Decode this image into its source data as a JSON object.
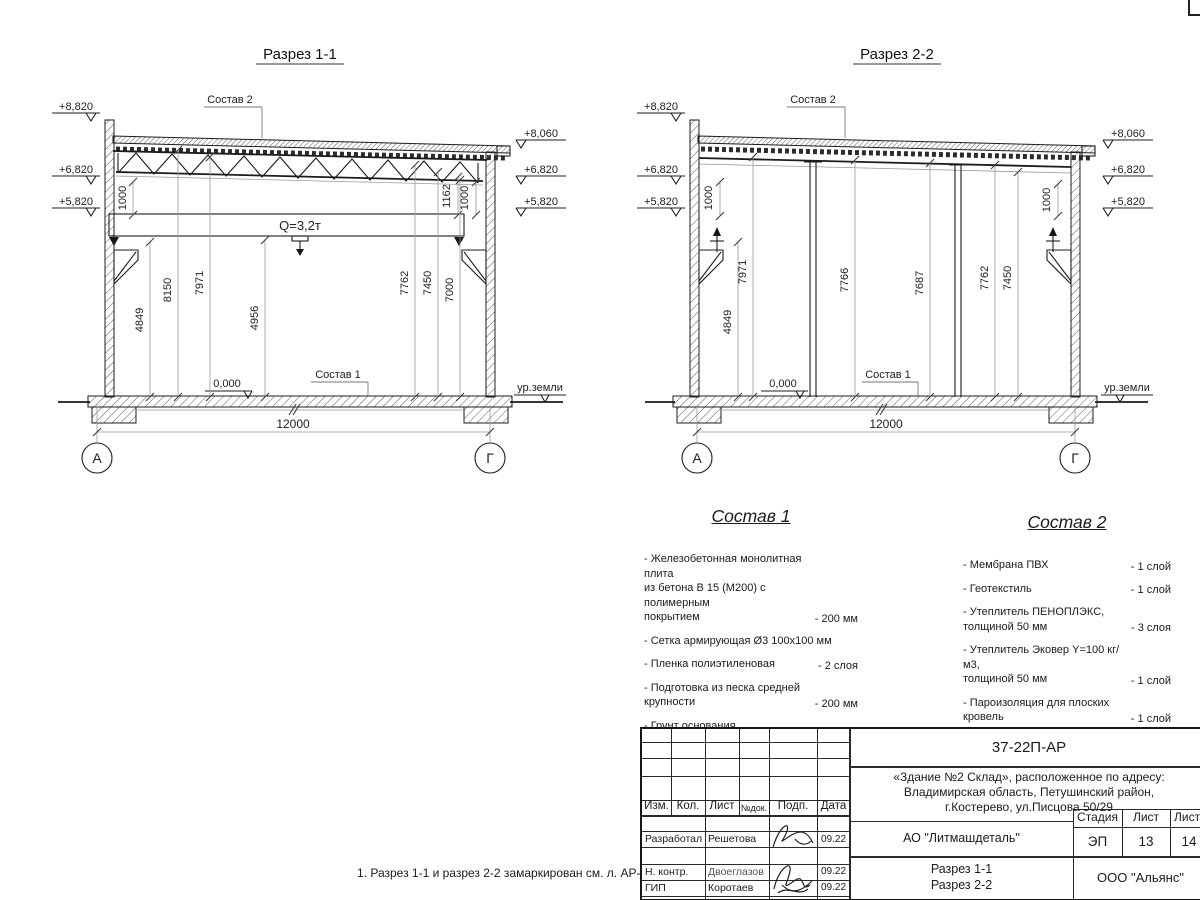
{
  "s1": {
    "title": "Разрез 1-1",
    "elev_left": [
      "+8,820",
      "+6,820",
      "+5,820"
    ],
    "elev_right": [
      "+8,060",
      "+6,820",
      "+5,820"
    ],
    "sostav2_label": "Состав 2",
    "sostav1_label": "Состав 1",
    "crane_label": "Q=3,2т",
    "dim_1000_left": "1000",
    "dim_1162": "1162",
    "dim_1000_right": "1000",
    "vdims": [
      "4849",
      "8150",
      "7971",
      "4956",
      "7762",
      "7450",
      "7000"
    ],
    "zero_level": "0,000",
    "ground_label": "ур.земли",
    "span_dim": "12000",
    "axis_left": "А",
    "axis_right": "Г"
  },
  "s2": {
    "title": "Разрез 2-2",
    "elev_left": [
      "+8,820",
      "+6,820",
      "+5,820"
    ],
    "elev_right": [
      "+8,060",
      "+6,820",
      "+5,820"
    ],
    "sostav2_label": "Состав 2",
    "sostav1_label": "Состав 1",
    "dim_1000_left": "1000",
    "dim_1000_right": "1000",
    "vdims": [
      "4849",
      "7971",
      "7766",
      "7687",
      "7762",
      "7450"
    ],
    "zero_level": "0,000",
    "ground_label": "ур.земли",
    "span_dim": "12000",
    "axis_left": "А",
    "axis_right": "Г"
  },
  "sostav1": {
    "title": "Состав 1",
    "items": [
      {
        "text": "- Железобетонная  монолитная плита\nиз бетона В 15 (М200) с полимерным\nпокрытием",
        "value": "- 200 мм"
      },
      {
        "text": "- Сетка армирующая Ø3 100х100 мм",
        "value": ""
      },
      {
        "text": "- Пленка полиэтиленовая",
        "value": "- 2 слоя"
      },
      {
        "text": "- Подготовка из песка средней\n  крупности",
        "value": "- 200 мм"
      },
      {
        "text": "- Грунт основания",
        "value": ""
      }
    ]
  },
  "sostav2": {
    "title": "Состав 2",
    "items": [
      {
        "text": "- Мембрана ПВХ",
        "value": "- 1 слой"
      },
      {
        "text": "- Геотекстиль",
        "value": "- 1 слой"
      },
      {
        "text": "- Утеплитель ПЕНОПЛЭКС,\n  толщиной 50 мм",
        "value": "- 3 слоя"
      },
      {
        "text": "- Утеплитель Эковер Y=100 кг/м3,\n  толщиной 50 мм",
        "value": "- 1 слой"
      },
      {
        "text": "- Пароизоляция для плоских кровель",
        "value": "- 1 слой"
      },
      {
        "text": "- Профлист Н 114х0.9 мм",
        "value": ""
      },
      {
        "text": "- Металлическая ферма\n  (с торца металлическая балка)",
        "value": ""
      }
    ]
  },
  "note": "1. Разрез 1-1 и разрез 2-2 замаркирован см. л. АР-11.",
  "tb": {
    "doc_number": "37-22П-АР",
    "project_line1": "«Здание №2 Склад», расположенное по адресу:",
    "project_line2": "Владимирская область, Петушинский район,",
    "project_line3": "г.Костерево, ул.Писцова 50/29",
    "col_izm": "Изм.",
    "col_kol": "Кол.",
    "col_list": "Лист",
    "col_ndok": "№док.",
    "col_podp": "Подп.",
    "col_data": "Дата",
    "row1_role": "Разработал",
    "row1_name": "Решетова",
    "row1_date": "09.22",
    "row2_role": "Н. контр.",
    "row2_name": "Двоеглазов",
    "row2_date": "09.22",
    "row3_role": "ГИП",
    "row3_name": "Коротаев",
    "row3_date": "09.22",
    "company": "АО \"Литмашдеталь\"",
    "stage_label": "Стадия",
    "sheet_label": "Лист",
    "sheets_label": "Листов",
    "stage_value": "ЭП",
    "sheet_value": "13",
    "sheets_value": "14",
    "content_line1": "Разрез 1-1",
    "content_line2": "Разрез 2-2",
    "org": "ООО \"Альянс\""
  }
}
